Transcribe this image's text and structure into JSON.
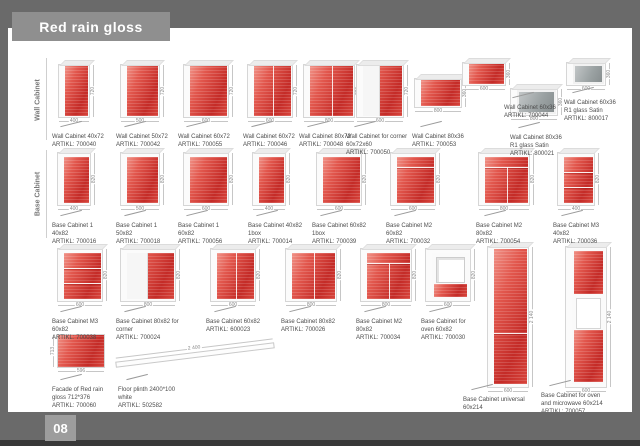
{
  "page": {
    "title": "Red rain gloss",
    "page_number": "08"
  },
  "colors": {
    "accent_red": "#c42b27",
    "banner_gray": "#8f8f8f",
    "frame_gray": "#6a6a6a",
    "satin_gray": "#9aa1a2"
  },
  "sections": [
    {
      "label": "Wall Cabinet"
    },
    {
      "label": "Base Cabinet"
    }
  ],
  "artikl_prefix": "ARTIKL:",
  "products": [
    {
      "name": "Wall Cabinet 40x72",
      "artikl": "ARTIKL: 700040",
      "kind": "wall",
      "color": "red",
      "x": 58,
      "y": 64,
      "cw": 32,
      "ch": 54,
      "features": [],
      "dim_w": "400",
      "dim_h": "720",
      "lx": 52,
      "ly": 126
    },
    {
      "name": "Wall Cabinet 50x72",
      "artikl": "ARTIKL: 700042",
      "kind": "wall",
      "color": "red",
      "x": 120,
      "y": 64,
      "cw": 40,
      "ch": 54,
      "features": [],
      "dim_w": "500",
      "dim_h": "720",
      "lx": 116,
      "ly": 126
    },
    {
      "name": "Wall Cabinet 60x72",
      "artikl": "ARTIKL: 700055",
      "kind": "wall",
      "color": "red",
      "x": 183,
      "y": 64,
      "cw": 46,
      "ch": 54,
      "features": [],
      "dim_w": "600",
      "dim_h": "720",
      "lx": 178,
      "ly": 126
    },
    {
      "name": "Wall Cabinet 60x72",
      "artikl": "ARTIKL: 700046",
      "kind": "wall",
      "color": "red",
      "x": 247,
      "y": 64,
      "cw": 46,
      "ch": 54,
      "features": [
        "split:0"
      ],
      "dim_w": "600",
      "dim_h": "720",
      "lx": 243,
      "ly": 126
    },
    {
      "name": "Wall Cabinet 80x72",
      "artikl": "ARTIKL: 700048",
      "kind": "wall",
      "color": "red",
      "x": 303,
      "y": 64,
      "cw": 52,
      "ch": 54,
      "features": [
        "split:0"
      ],
      "dim_w": "800",
      "dim_h": "720",
      "lx": 299,
      "ly": 126
    },
    {
      "name": "Wall Cabinet for corner 60x72x60",
      "artikl": "ARTIKL: 700050",
      "kind": "wall",
      "color": "red",
      "x": 356,
      "y": 64,
      "cw": 48,
      "ch": 54,
      "features": [
        "wing"
      ],
      "dim_w": "600",
      "dim_h": "720",
      "lx": 346,
      "ly": 126,
      "lw": 72
    },
    {
      "name": "Wall Cabinet 80x36",
      "artikl": "ARTIKL: 700053",
      "kind": "wall",
      "color": "red",
      "x": 414,
      "y": 78,
      "cw": 48,
      "ch": 30,
      "features": [],
      "dim_w": "800",
      "dim_h": "360",
      "lx": 412,
      "ly": 126
    },
    {
      "name": "Wall Cabinet 60x36",
      "artikl": "ARTIKL: 700044",
      "kind": "wall",
      "color": "red",
      "x": 462,
      "y": 62,
      "cw": 44,
      "ch": 24,
      "features": [],
      "dim_w": "600",
      "dim_h": "360",
      "lx": 504,
      "ly": 97,
      "lw": 52
    },
    {
      "name": "Wall Cabinet 80x36 R1 glass Satin",
      "artikl": "ARTIKL: 800021",
      "kind": "wall",
      "color": "gray",
      "x": 510,
      "y": 88,
      "cw": 48,
      "ch": 28,
      "features": [],
      "dim_w": "800",
      "dim_h": "360",
      "lx": 510,
      "ly": 127,
      "lw": 56
    },
    {
      "name": "Wall Cabinet 60x36 R1 glass Satin",
      "artikl": "ARTIKL: 800017",
      "kind": "wall",
      "color": "gray",
      "x": 566,
      "y": 62,
      "cw": 40,
      "ch": 24,
      "features": [],
      "dim_w": "600",
      "dim_h": "360",
      "lx": 564,
      "ly": 92,
      "lw": 52
    },
    {
      "name": "Base Cabinet 1 40x82",
      "artikl": "ARTIKL: 700016",
      "kind": "base",
      "color": "red",
      "x": 57,
      "y": 152,
      "cw": 34,
      "ch": 54,
      "features": [],
      "dim_w": "400",
      "dim_h": "820",
      "lx": 52,
      "ly": 215
    },
    {
      "name": "Base Cabinet 1 50x82",
      "artikl": "ARTIKL: 700018",
      "kind": "base",
      "color": "red",
      "x": 120,
      "y": 152,
      "cw": 40,
      "ch": 54,
      "features": [],
      "dim_w": "500",
      "dim_h": "820",
      "lx": 116,
      "ly": 215
    },
    {
      "name": "Base Cabinet 1 60x82",
      "artikl": "ARTIKL: 700056",
      "kind": "base",
      "color": "red",
      "x": 183,
      "y": 152,
      "cw": 46,
      "ch": 54,
      "features": [],
      "dim_w": "600",
      "dim_h": "820",
      "lx": 178,
      "ly": 215
    },
    {
      "name": "Base Cabinet 40x82 1box",
      "artikl": "ARTIKL: 700014",
      "kind": "base",
      "color": "red",
      "x": 252,
      "y": 152,
      "cw": 34,
      "ch": 54,
      "features": [],
      "dim_w": "400",
      "dim_h": "820",
      "lx": 248,
      "ly": 215
    },
    {
      "name": "Base Cabinet 60x82 1box",
      "artikl": "ARTIKL: 700039",
      "kind": "base",
      "color": "red",
      "x": 316,
      "y": 152,
      "cw": 46,
      "ch": 54,
      "features": [],
      "dim_w": "600",
      "dim_h": "820",
      "lx": 312,
      "ly": 215
    },
    {
      "name": "Base Cabinet M2 60x82",
      "artikl": "ARTIKL: 700032",
      "kind": "base",
      "color": "red",
      "x": 390,
      "y": 152,
      "cw": 46,
      "ch": 54,
      "features": [
        "hline:22"
      ],
      "dim_w": "600",
      "dim_h": "820",
      "lx": 386,
      "ly": 215
    },
    {
      "name": "Base Cabinet M2 80x82",
      "artikl": "ARTIKL: 700054",
      "kind": "base",
      "color": "red",
      "x": 478,
      "y": 152,
      "cw": 52,
      "ch": 54,
      "features": [
        "hline:22",
        "split:22"
      ],
      "dim_w": "800",
      "dim_h": "820",
      "lx": 476,
      "ly": 215
    },
    {
      "name": "Base Cabinet M3 40x82",
      "artikl": "ARTIKL: 700036",
      "kind": "base",
      "color": "red",
      "x": 557,
      "y": 152,
      "cw": 38,
      "ch": 54,
      "features": [
        "hline:33",
        "hline:66"
      ],
      "dim_w": "400",
      "dim_h": "820",
      "lx": 553,
      "ly": 215
    },
    {
      "name": "Base Cabinet M3 60x82",
      "artikl": "ARTIKL: 700038",
      "kind": "base",
      "color": "red",
      "x": 57,
      "y": 248,
      "cw": 46,
      "ch": 54,
      "features": [
        "hline:33",
        "hline:66"
      ],
      "dim_w": "600",
      "dim_h": "820",
      "lx": 52,
      "ly": 311
    },
    {
      "name": "Base Cabinet 80x82 for corner",
      "artikl": "ARTIKL: 700024",
      "kind": "base",
      "color": "red",
      "x": 120,
      "y": 248,
      "cw": 56,
      "ch": 54,
      "features": [
        "wing"
      ],
      "dim_w": "800",
      "dim_h": "820",
      "lx": 116,
      "ly": 311,
      "lw": 70
    },
    {
      "name": "Base Cabinet 60x82",
      "artikl": "ARTIKL: 600023",
      "kind": "base",
      "color": "red",
      "x": 210,
      "y": 248,
      "cw": 46,
      "ch": 54,
      "features": [
        "split:0"
      ],
      "dim_w": "600",
      "dim_h": "820",
      "lx": 206,
      "ly": 311
    },
    {
      "name": "Base Cabinet 80x82",
      "artikl": "ARTIKL: 700026",
      "kind": "base",
      "color": "red",
      "x": 285,
      "y": 248,
      "cw": 52,
      "ch": 54,
      "features": [
        "split:0"
      ],
      "dim_w": "800",
      "dim_h": "820",
      "lx": 281,
      "ly": 311
    },
    {
      "name": "Base Cabinet M2 80x82",
      "artikl": "ARTIKL: 700034",
      "kind": "base",
      "color": "red",
      "x": 360,
      "y": 248,
      "cw": 52,
      "ch": 54,
      "features": [
        "hline:22",
        "split:22"
      ],
      "dim_w": "800",
      "dim_h": "820",
      "lx": 356,
      "ly": 311
    },
    {
      "name": "Base Cabinet for oven 60x82",
      "artikl": "ARTIKL: 700030",
      "kind": "base",
      "color": "white",
      "x": 425,
      "y": 248,
      "cw": 46,
      "ch": 54,
      "features": [
        "niche"
      ],
      "dim_w": "600",
      "dim_h": "820",
      "lx": 421,
      "ly": 311,
      "lw": 56
    },
    {
      "name": "Base Cabinet universal 60x214",
      "artikl": "ARTIKL: 700058",
      "kind": "tall",
      "color": "red",
      "x": 487,
      "y": 246,
      "cw": 42,
      "ch": 142,
      "features": [
        "hline:62"
      ],
      "dim_w": "600",
      "dim_h": "2 140",
      "lx": 463,
      "ly": 389,
      "lw": 64
    },
    {
      "name": "Base Cabinet for oven and microwave 60x214",
      "artikl": "ARTIKL: 700057",
      "kind": "tall",
      "color": "white",
      "x": 565,
      "y": 246,
      "cw": 42,
      "ch": 142,
      "features": [
        "tallniche"
      ],
      "dim_w": "600",
      "dim_h": "2 140",
      "lx": 541,
      "ly": 385,
      "lw": 62
    },
    {
      "name": "Facade of Red rain gloss 712*376",
      "artikl": "ARTIKL: 700060",
      "kind": "flat",
      "color": "red",
      "x": 57,
      "y": 334,
      "cw": 48,
      "ch": 34,
      "features": [],
      "dim_w": "596",
      "dim_h": "713",
      "dimh_left": true,
      "lx": 52,
      "ly": 379,
      "lw": 56
    },
    {
      "name": "Floor plinth 2400*100 white",
      "artikl": "ARTIKL: 502582",
      "kind": "plinth",
      "color": "white",
      "x": 115,
      "y": 352,
      "cw": 160,
      "ch": 6,
      "rot": -7,
      "features": [],
      "dim_w": "2 400",
      "dim_top": true,
      "lx": 118,
      "ly": 379,
      "lw": 70
    }
  ]
}
